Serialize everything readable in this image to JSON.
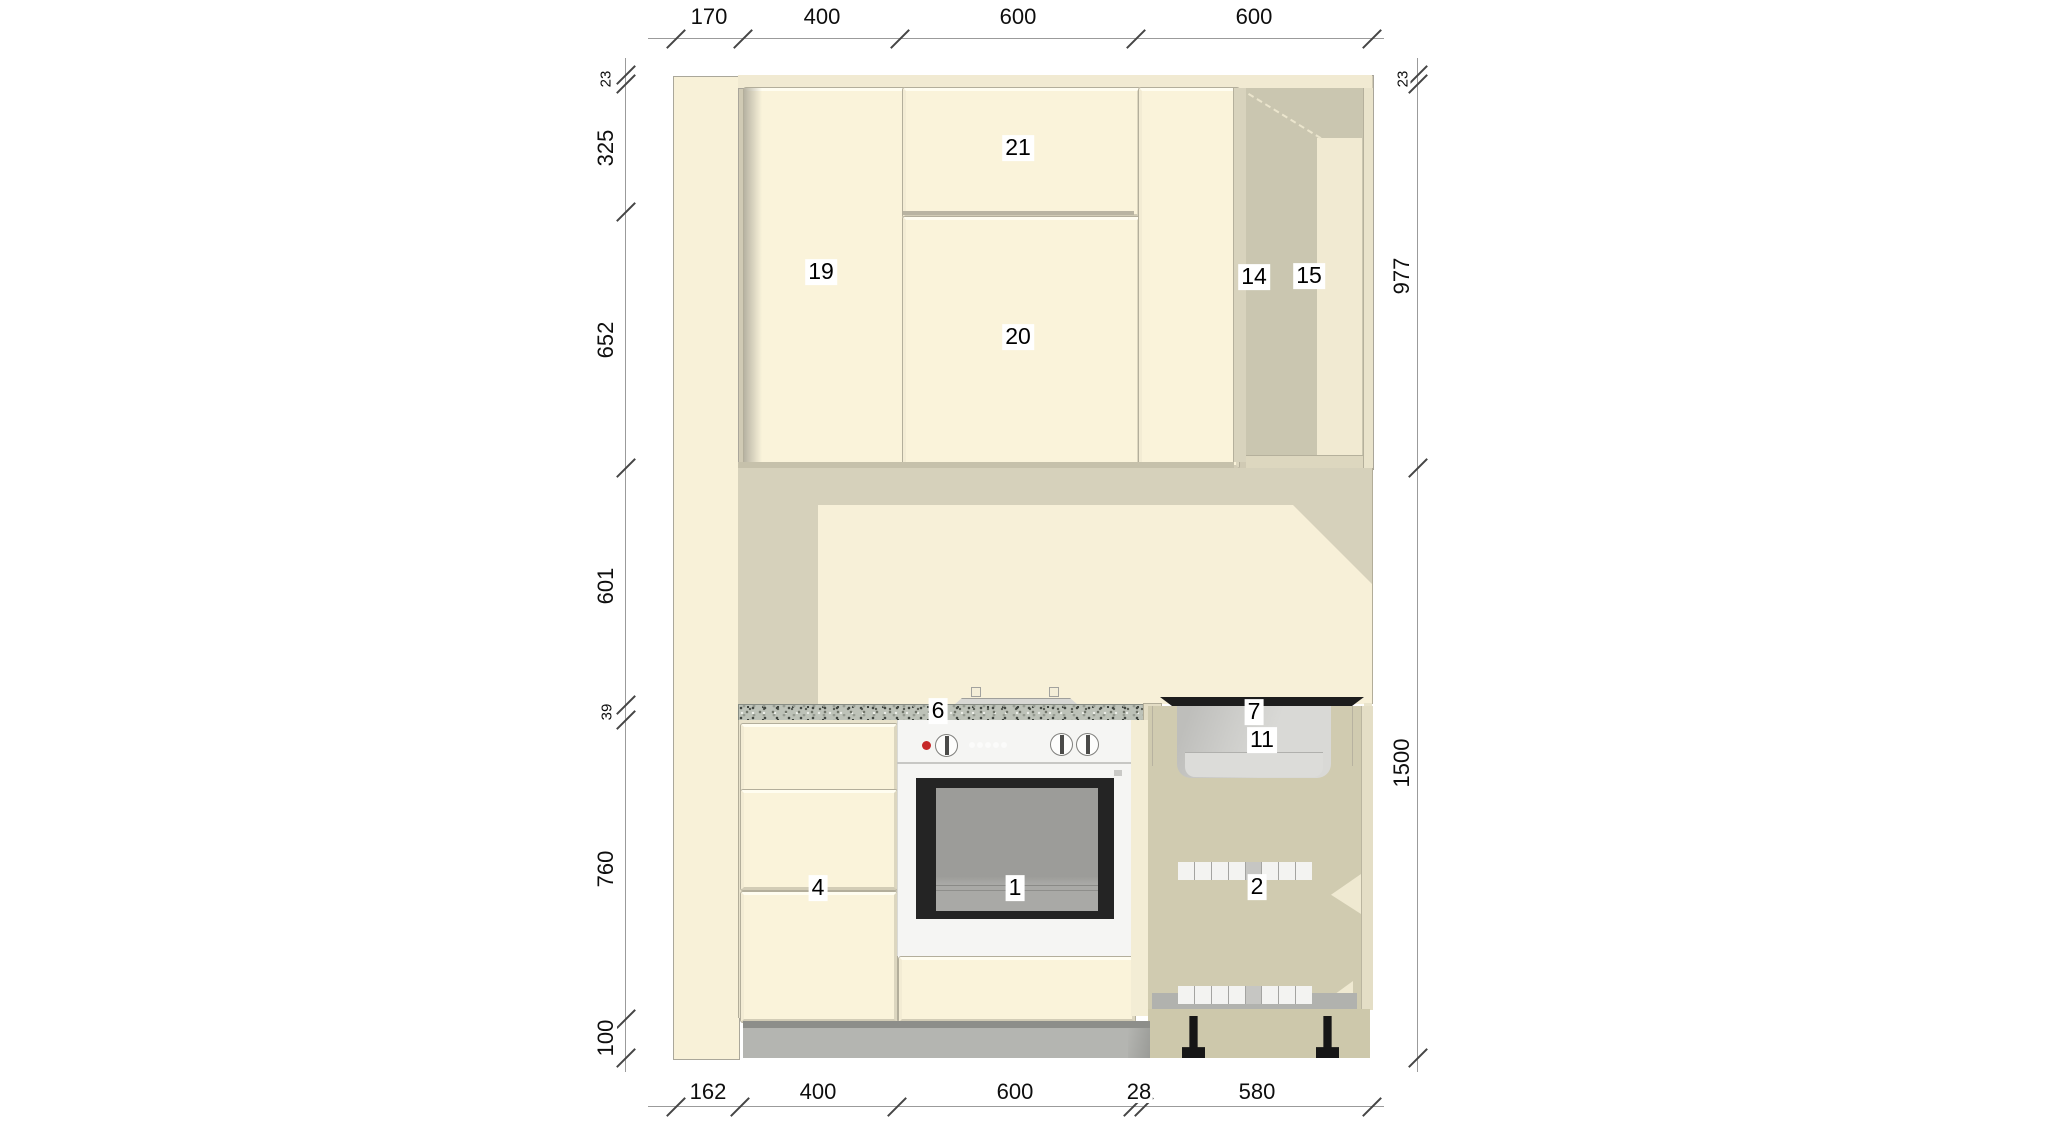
{
  "meta": {
    "view": "kitchen-elevation-drawing",
    "canvas": {
      "width": 2048,
      "height": 1133,
      "background": "#ffffff"
    }
  },
  "item_labels": [
    {
      "id": "oven",
      "text": "1"
    },
    {
      "id": "dishwasher",
      "text": "2"
    },
    {
      "id": "drawer-unit",
      "text": "4"
    },
    {
      "id": "worktop",
      "text": "6"
    },
    {
      "id": "hob",
      "text": "7"
    },
    {
      "id": "sink",
      "text": "11"
    },
    {
      "id": "corner-carcass",
      "text": "14"
    },
    {
      "id": "corner-shelf",
      "text": "15"
    },
    {
      "id": "wall-unit-left",
      "text": "19"
    },
    {
      "id": "wall-unit-door",
      "text": "20"
    },
    {
      "id": "wall-unit-top",
      "text": "21"
    }
  ],
  "dimensions": {
    "top": {
      "values": [
        "170",
        "400",
        "600",
        "600"
      ]
    },
    "bottom": {
      "values": [
        "162",
        "400",
        "600",
        "28",
        "580"
      ]
    },
    "left": {
      "values": [
        "23",
        "325",
        "652",
        "601",
        "39",
        "760",
        "100"
      ]
    },
    "right": {
      "values": [
        "23",
        "977",
        "1500"
      ]
    }
  },
  "colors": {
    "door_cream": "#faf3da",
    "side_panel": "#f8f1d8",
    "wall_shadow_beige": "#d6d1bb",
    "wall_light_cream": "#f7f0d8",
    "corner_interior": "#cac6b0",
    "corner_shelf_strip": "#f1ead2",
    "granite_worktop": "#bdc2b8",
    "plinth_gray": "#b4b5b1",
    "dishwasher_interior": "#d0cbb0",
    "appliance_white": "#f5f5f3",
    "oven_door_frame": "#242424",
    "oven_glass": "#9c9c99",
    "hob_black": "#1d1d1d",
    "indicator_red": "#c62828",
    "dimension_line": "#9b9b9b",
    "dimension_text": "#0e0e0e"
  }
}
